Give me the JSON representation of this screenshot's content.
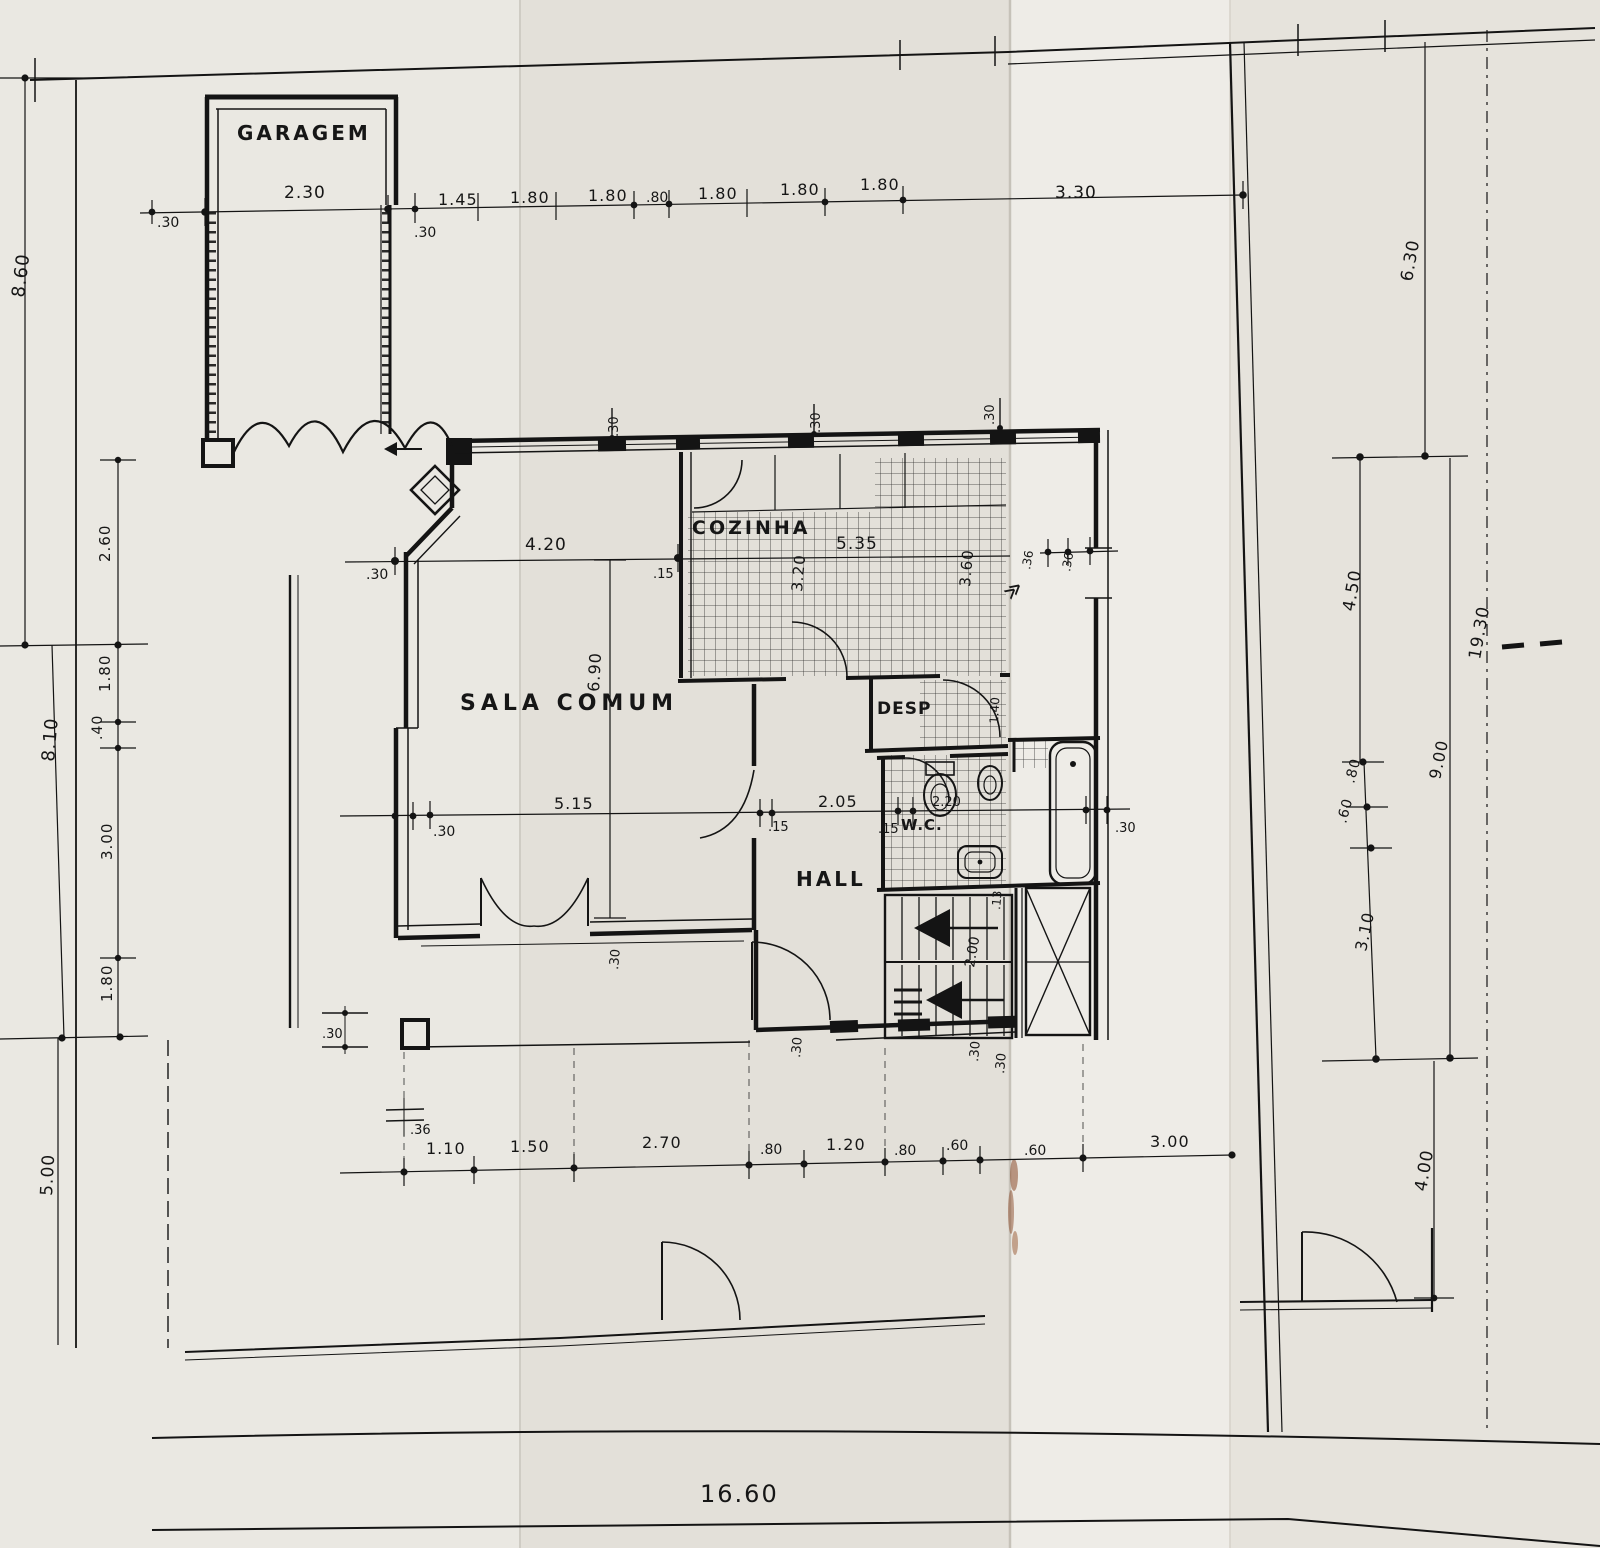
{
  "meta": {
    "document_type": "scanned architectural floor plan",
    "language": "Portuguese",
    "paper_color": "#e7e4de",
    "ink_color": "#141414"
  },
  "rooms": {
    "garagem": "GARAGEM",
    "sala_comum": "SALA COMUM",
    "cozinha": "COZINHA",
    "desp": "DESP",
    "wc": "W.C.",
    "hall": "HALL"
  },
  "dims": {
    "top_chain": [
      ".30",
      "2.30",
      ".30",
      "1.45",
      "1.80",
      "1.80",
      ".80",
      "1.80",
      "1.80",
      "1.80",
      "3.30"
    ],
    "left_outer": [
      "8.60",
      "8.10",
      "5.00"
    ],
    "left_inner": [
      "2.60",
      "1.80",
      ".40",
      "3.00",
      "1.80"
    ],
    "right_inner": [
      "6.30",
      "4.50",
      ".80",
      ".60",
      "3.10",
      "4.00"
    ],
    "right_outer": [
      "9.00",
      "19.30"
    ],
    "bottom_chain": [
      ".36",
      "1.10",
      "1.50",
      "2.70",
      ".80",
      "1.20",
      ".80",
      ".60",
      ".60",
      "3.00"
    ],
    "bottom_overall": "16.60",
    "sala": [
      "4.20",
      ".30",
      ".15",
      "6.90",
      ".30",
      "5.15",
      ".15",
      "2.05",
      ".15"
    ],
    "cozinha": [
      "5.35",
      "3.20",
      "3.60",
      ".36",
      ".36"
    ],
    "top_wall": [
      ".30",
      ".30",
      ".30"
    ],
    "wc": [
      "2.20",
      "1.40",
      ".30",
      ".13",
      "2.00",
      ".30"
    ],
    "south": [
      ".30",
      ".30",
      ".30",
      ".30"
    ]
  },
  "symbols": {
    "pass_chevron": "≫"
  }
}
